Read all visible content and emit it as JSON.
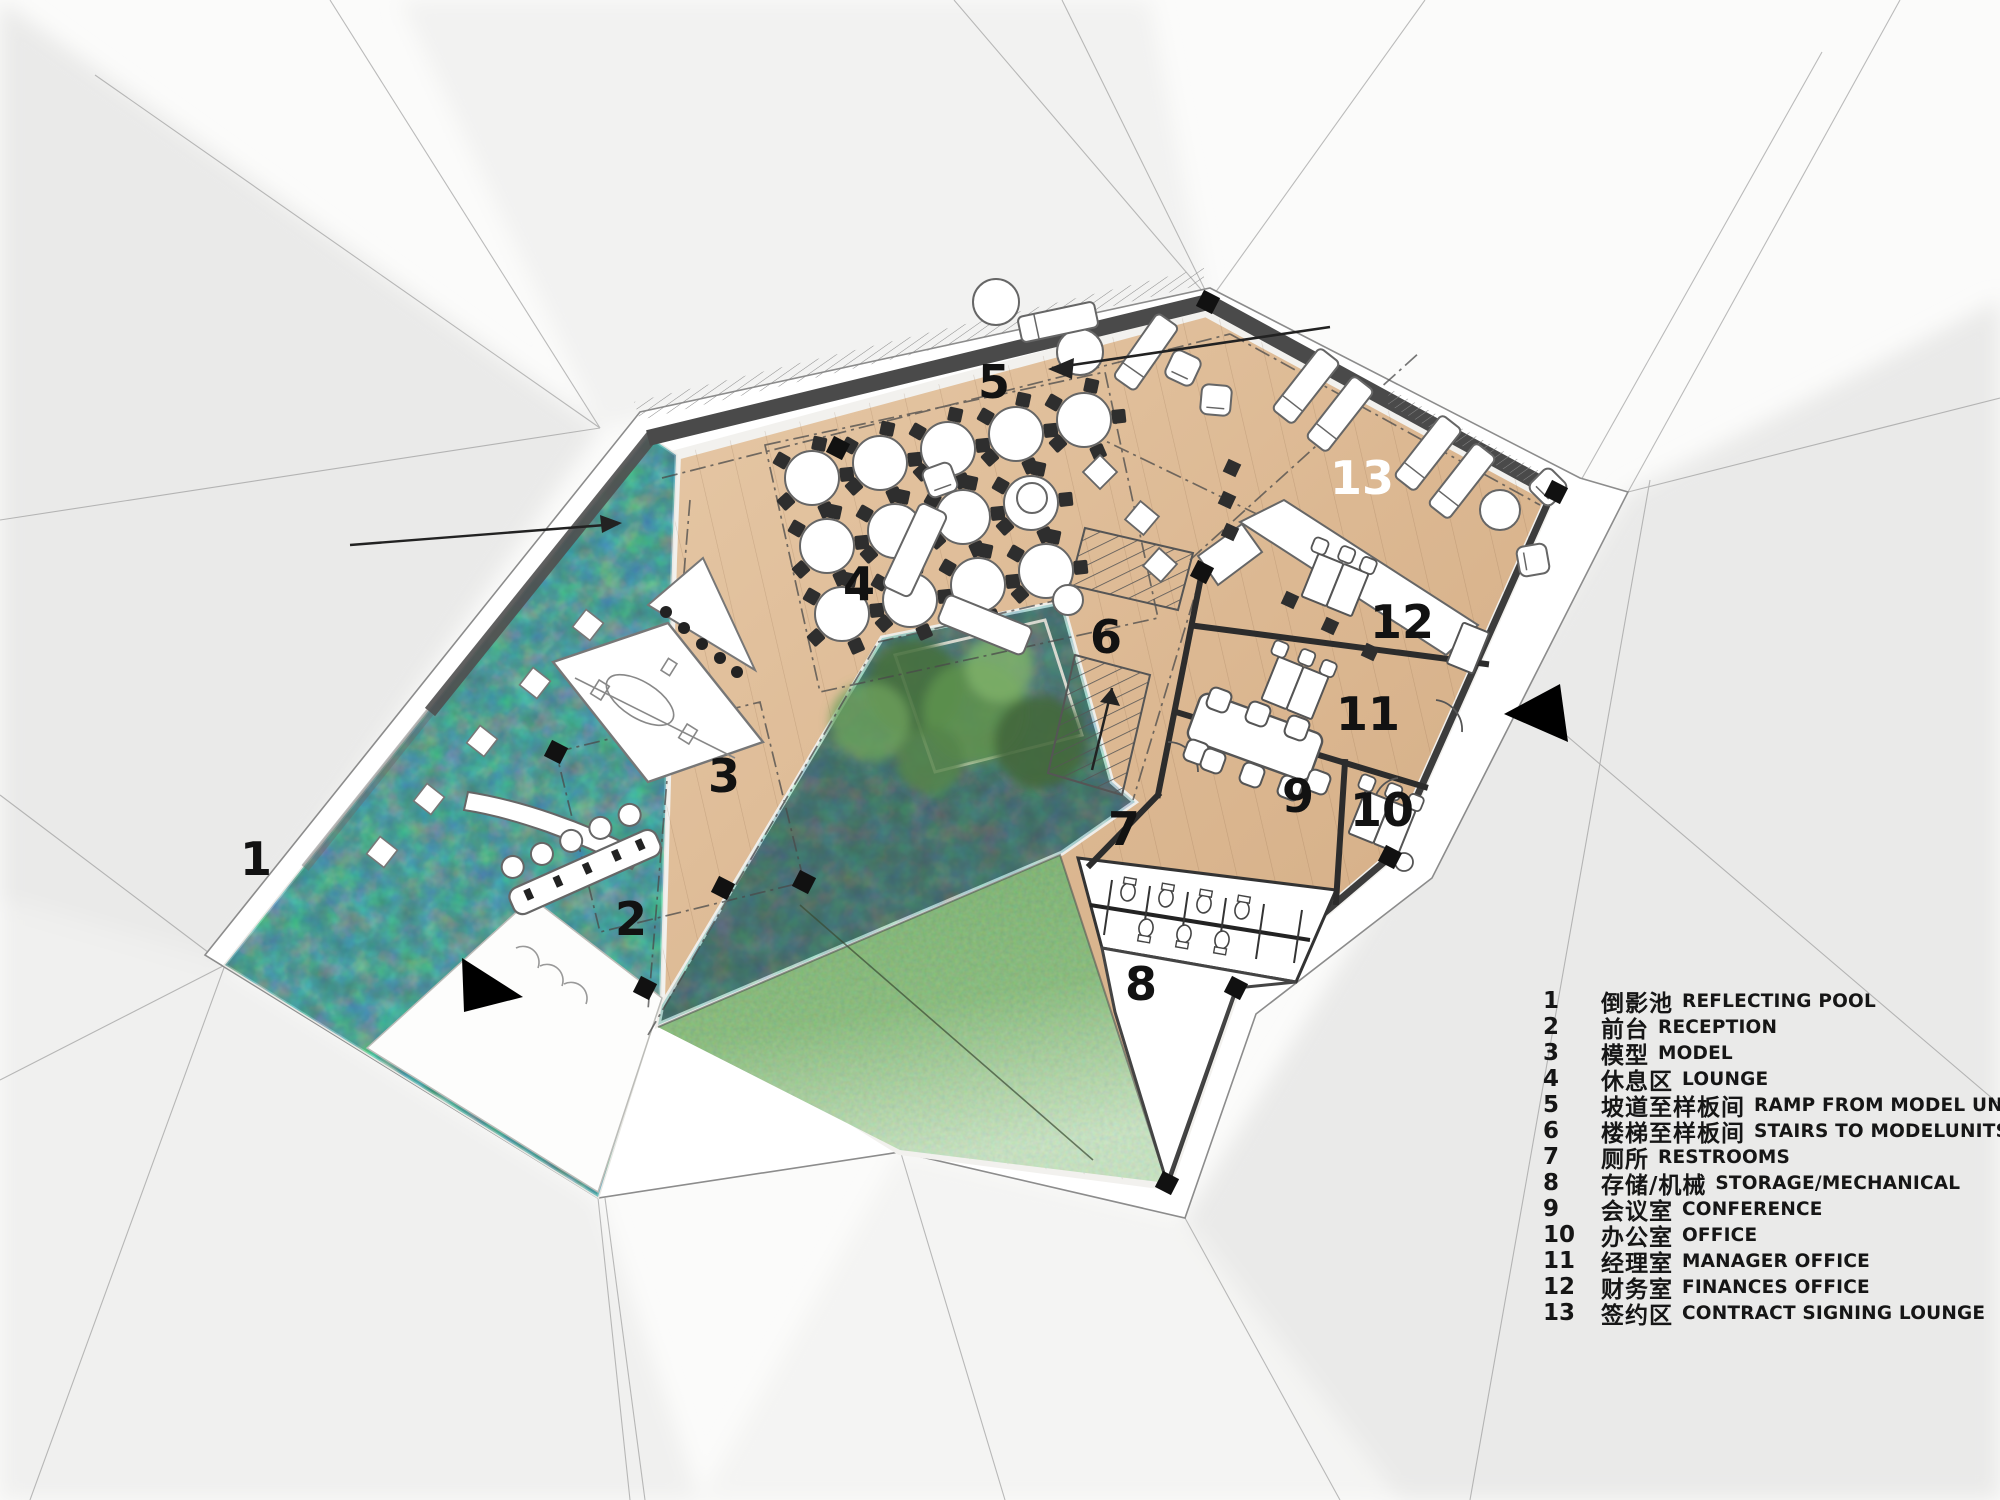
{
  "legend": {
    "items": [
      {
        "num": "1",
        "zh": "倒影池",
        "en": "REFLECTING POOL"
      },
      {
        "num": "2",
        "zh": "前台",
        "en": "RECEPTION"
      },
      {
        "num": "3",
        "zh": "模型",
        "en": "MODEL"
      },
      {
        "num": "4",
        "zh": "休息区",
        "en": "LOUNGE"
      },
      {
        "num": "5",
        "zh": "坡道至样板间",
        "en": "RAMP FROM MODEL UNITS"
      },
      {
        "num": "6",
        "zh": "楼梯至样板间",
        "en": "STAIRS TO MODELUNITS"
      },
      {
        "num": "7",
        "zh": "厕所",
        "en": "RESTROOMS"
      },
      {
        "num": "8",
        "zh": "存储/机械",
        "en": "STORAGE/MECHANICAL"
      },
      {
        "num": "9",
        "zh": "会议室",
        "en": "CONFERENCE"
      },
      {
        "num": "10",
        "zh": "办公室",
        "en": "OFFICE"
      },
      {
        "num": "11",
        "zh": "经理室",
        "en": "MANAGER OFFICE"
      },
      {
        "num": "12",
        "zh": "财务室",
        "en": "FINANCES OFFICE"
      },
      {
        "num": "13",
        "zh": "签约区",
        "en": "CONTRACT SIGNING LOUNGE"
      }
    ]
  },
  "colors": {
    "wood_floor": "#ddbb95",
    "pool_water": "#1d4b45",
    "lawn_green": "#5d9450",
    "courtyard_planter": "#3a423c",
    "wall_dark": "#4a4a4a",
    "label_black": "#121212",
    "label_white": "#ffffff",
    "background": "#fbfbfa"
  },
  "icons": {
    "southwest_entrance_arrow": "solid-triangle-right",
    "east_entrance_arrow": "solid-triangle-left",
    "ramp_direction_arrow": "line-arrow-left",
    "section_cut_arrow": "line-arrow-right"
  }
}
